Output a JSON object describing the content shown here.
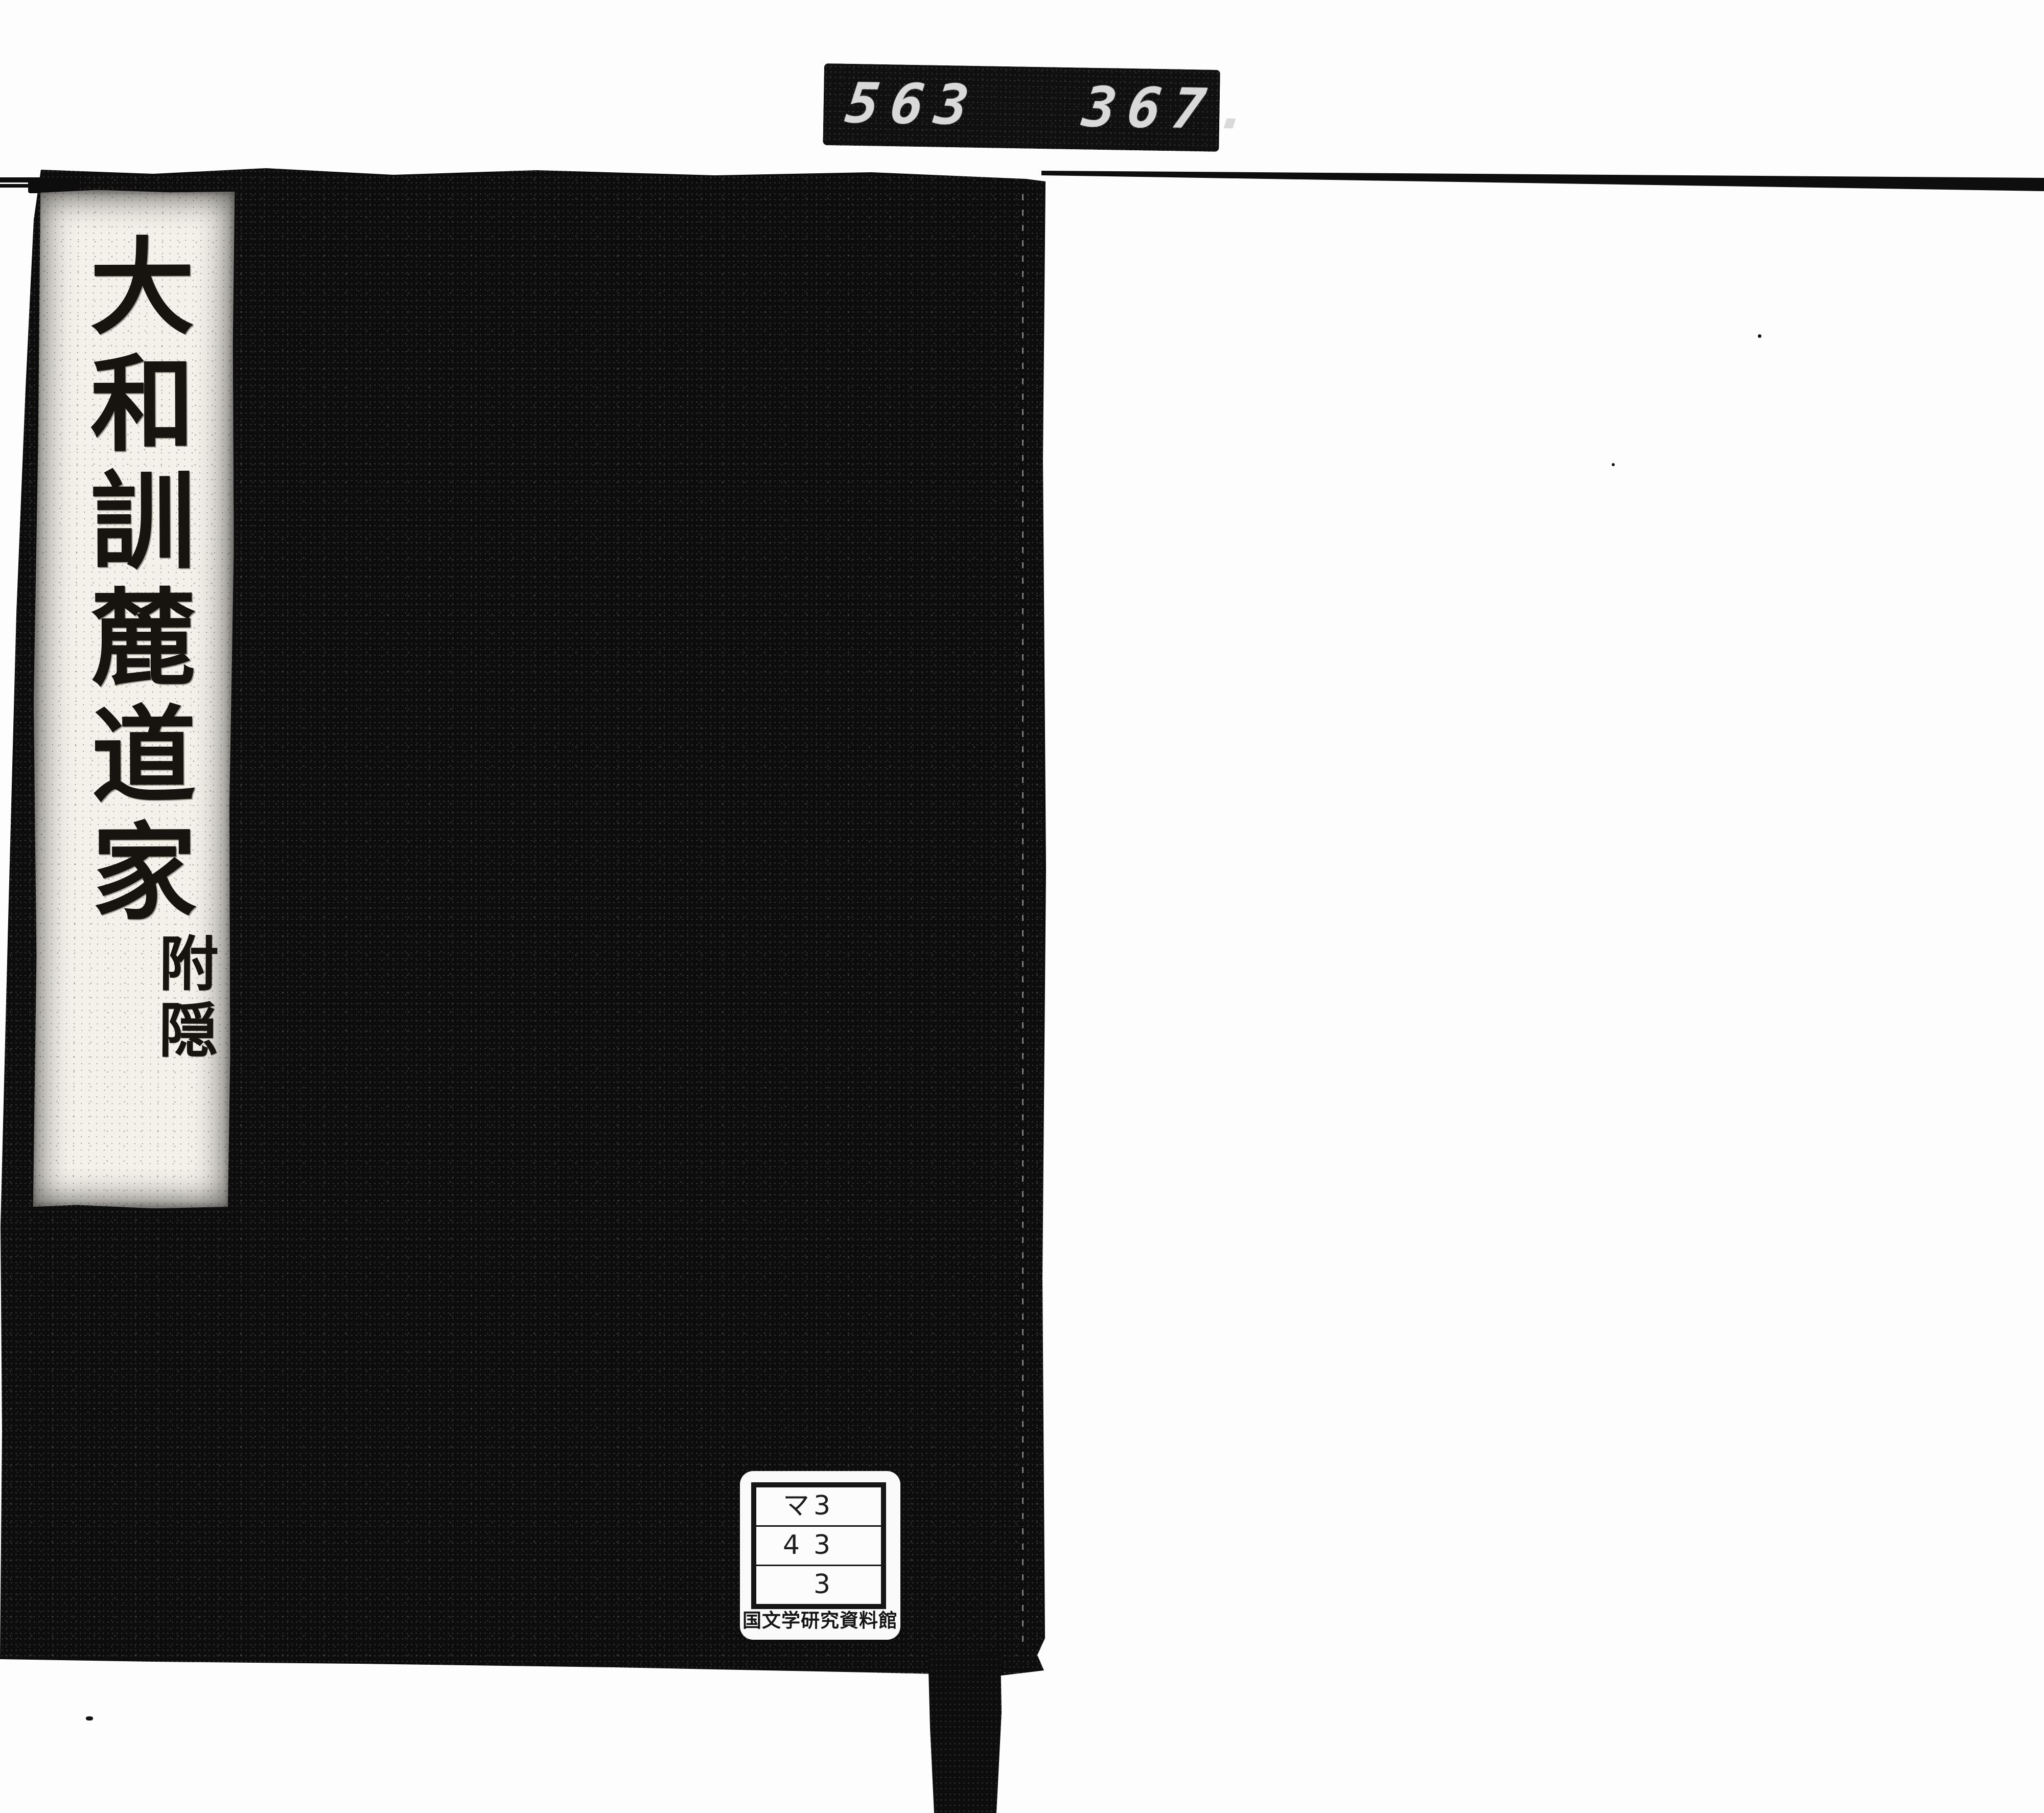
{
  "scan": {
    "background_color": "#fdfdfd",
    "ink_color": "#0d0d0d"
  },
  "counter": {
    "left_digits": "563",
    "right_digits": "367.",
    "display_bg_color": "#101010",
    "digit_color": "#d9d9d9"
  },
  "book": {
    "cover_color": "#0d0d0d",
    "title_slip": {
      "bg_color": "#f4f1ea",
      "title_vertical": "大和訓麓道家",
      "subtitle_vertical": "附隠"
    }
  },
  "label": {
    "bg_color": "#fafafa",
    "rows": [
      [
        "マ",
        "3"
      ],
      [
        "4",
        "3"
      ],
      [
        "",
        "3"
      ]
    ],
    "caption": "国文学研究資料館"
  }
}
